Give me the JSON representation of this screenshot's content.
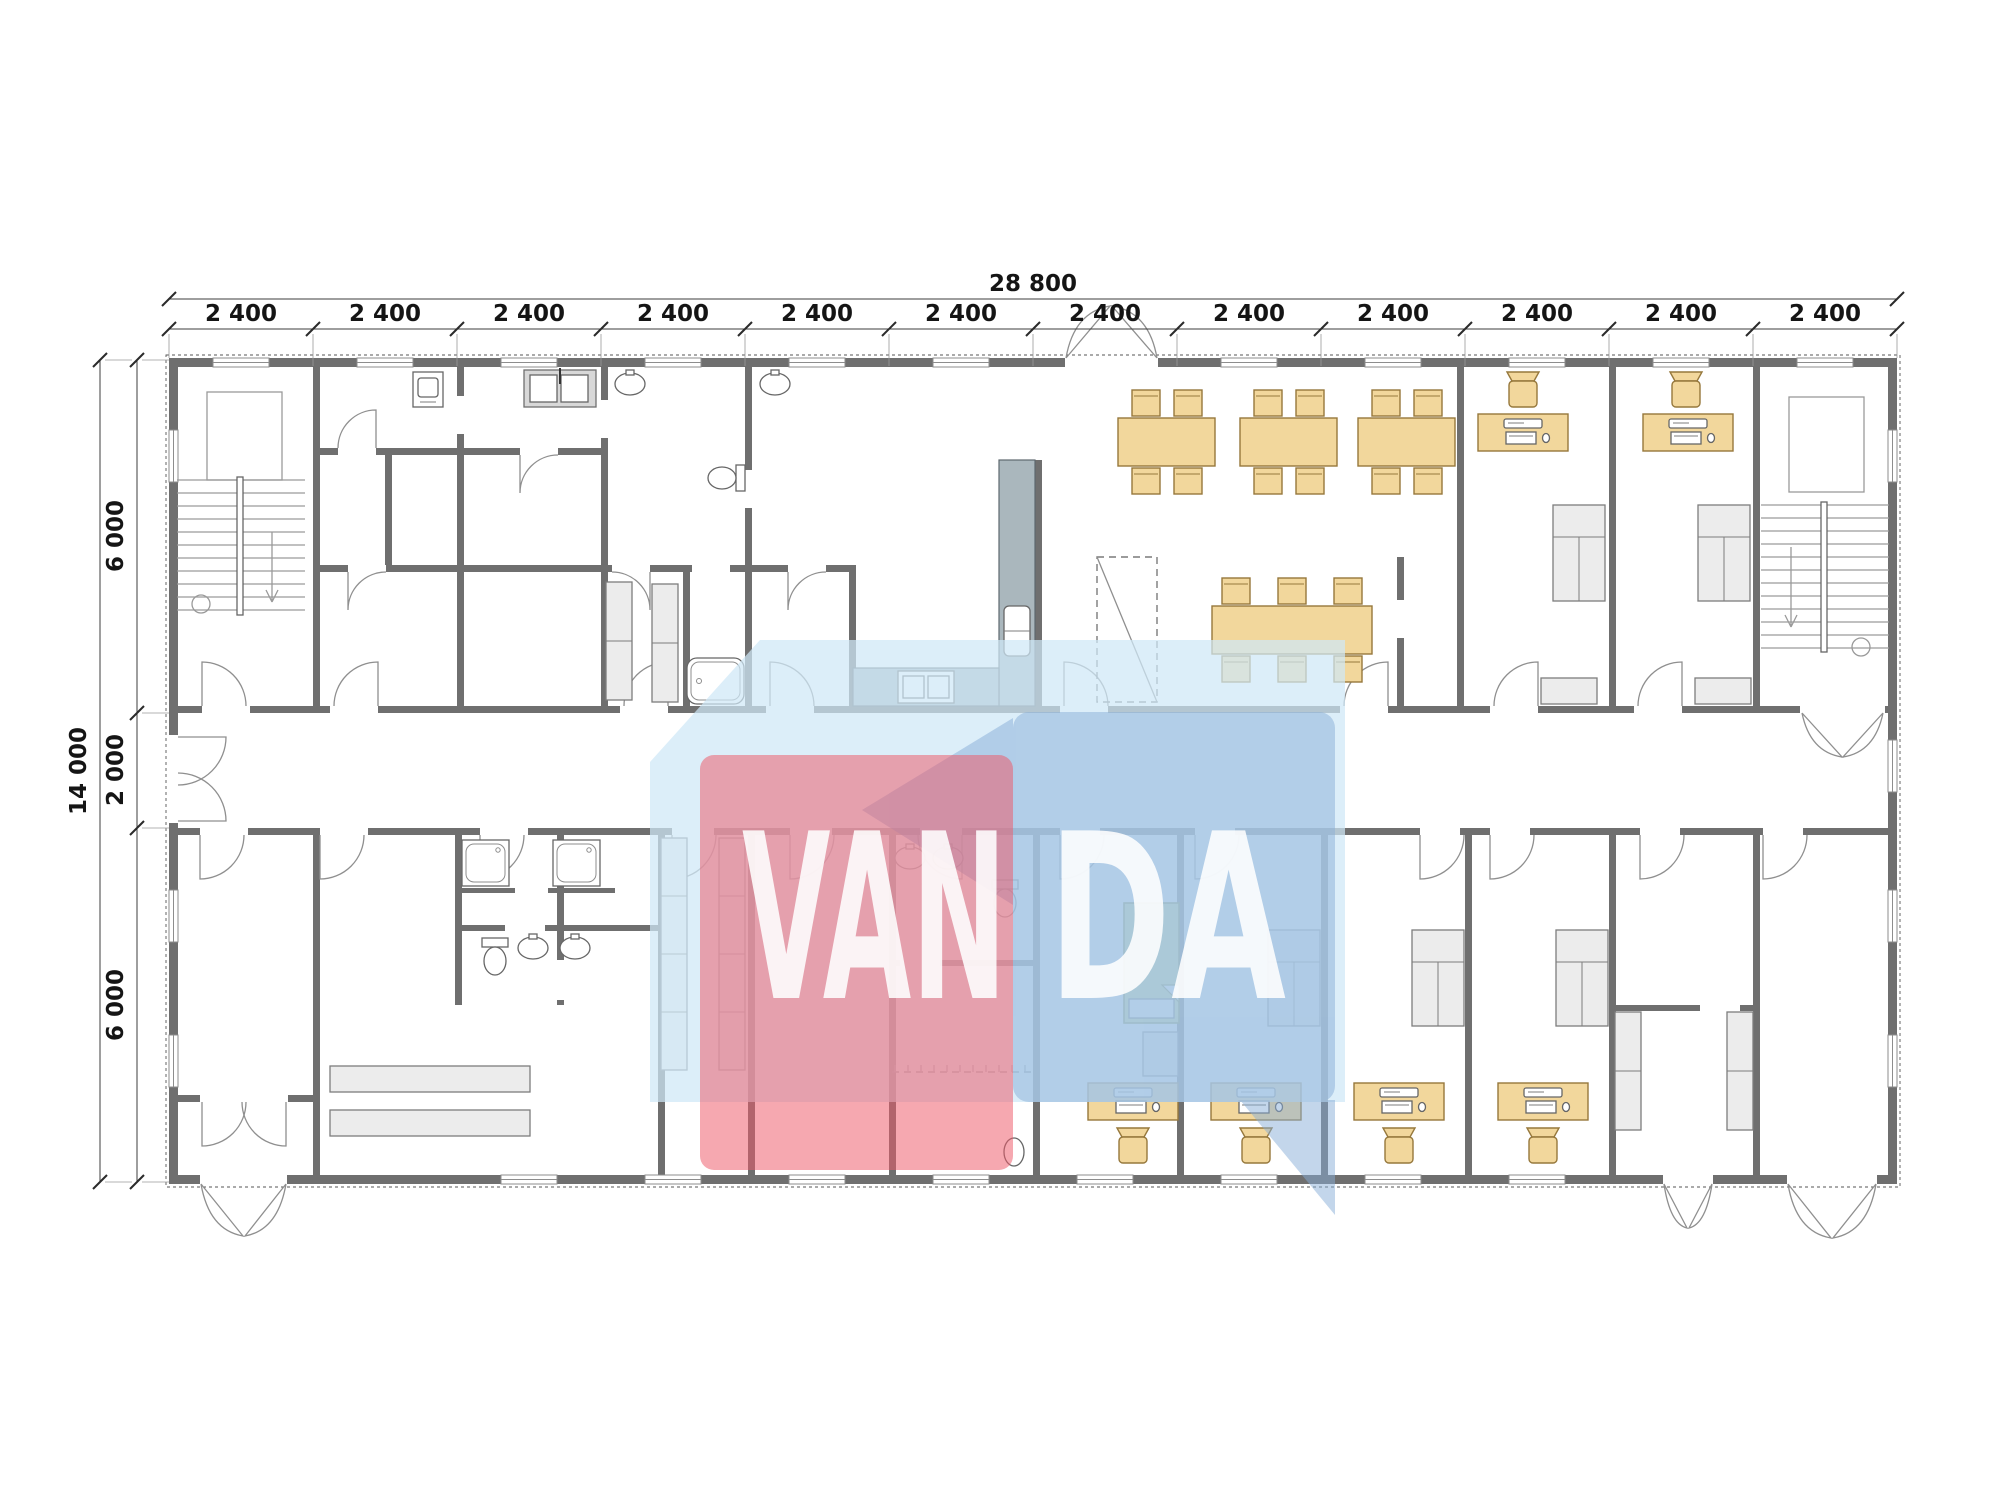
{
  "drawing": {
    "type": "architectural floor plan",
    "overall_width": "28 800",
    "overall_depth": "14 000",
    "top_segments": [
      "2 400",
      "2 400",
      "2 400",
      "2 400",
      "2 400",
      "2 400",
      "2 400",
      "2 400",
      "2 400",
      "2 400",
      "2 400",
      "2 400"
    ],
    "left_segments": [
      "6 000",
      "2 000",
      "6 000"
    ]
  },
  "watermark": {
    "left_text": "VAN",
    "right_text": "DA",
    "red_color": "#ee5b69",
    "blue_color": "#88aed8",
    "light_blue_color": "#cfe8f7"
  },
  "palette": {
    "wall": "#6f6f6f",
    "wood_furniture": "#f2d79c",
    "gray_furniture": "#ececec",
    "kitchen_counter": "#aab7bd",
    "bed_green": "#ccd98b"
  },
  "fixtures": {
    "dining_tables_4_seat": 3,
    "meeting_tables_6_seat": 1,
    "computer_workstations": 6,
    "beds": 1,
    "nightstands": 1,
    "wardrobes": 5,
    "tall_shelving_units": 6,
    "low_cabinets": 2,
    "showers": 2,
    "toilets": 3,
    "wash_basins": 7,
    "kitchen_sink_units": 3,
    "bathtubs": 1,
    "washing_machines": 1,
    "benches": 2,
    "staircases": 2,
    "double_entrance_doors": 3,
    "single_entrance_doors": 1
  }
}
